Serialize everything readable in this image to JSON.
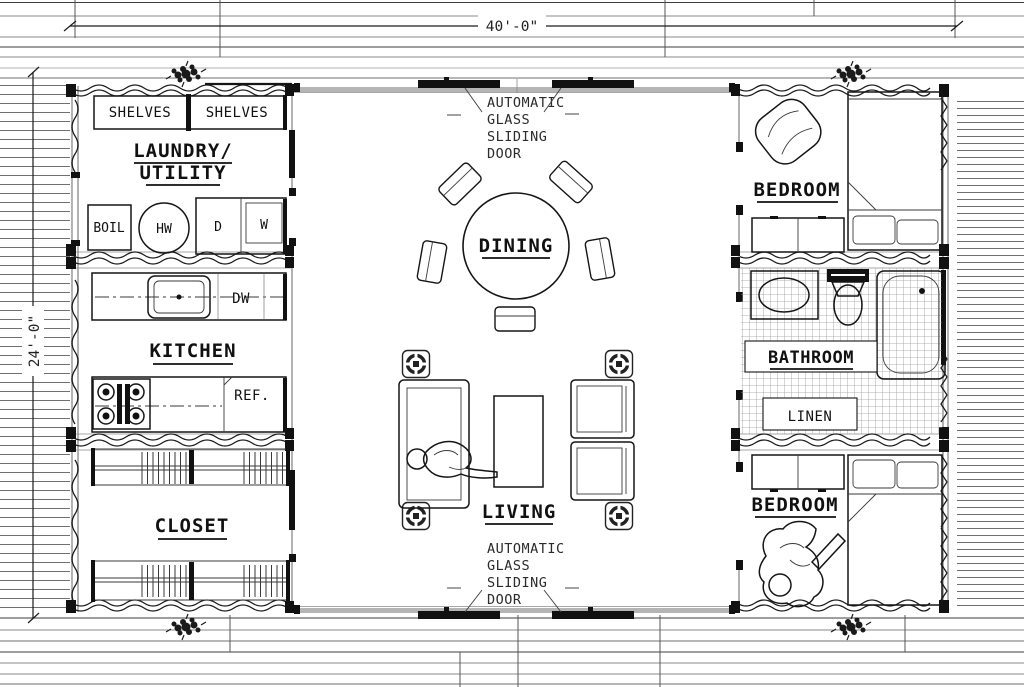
{
  "dimensions": {
    "width_label": "40'-0\"",
    "depth_label": "24'-0\""
  },
  "rooms": {
    "laundry_utility": {
      "name_line1": "LAUNDRY/",
      "name_line2": "UTILITY"
    },
    "kitchen": {
      "name": "KITCHEN"
    },
    "closet": {
      "name": "CLOSET"
    },
    "dining": {
      "name": "DINING"
    },
    "living": {
      "name": "LIVING"
    },
    "bedroom_top": {
      "name": "BEDROOM"
    },
    "bedroom_bottom": {
      "name": "BEDROOM"
    },
    "bathroom": {
      "name": "BATHROOM"
    },
    "linen": {
      "name": "LINEN"
    }
  },
  "fixtures": {
    "shelves_left": "SHELVES",
    "shelves_right": "SHELVES",
    "boiler": "BOIL",
    "hot_water": "HW",
    "dryer": "D",
    "washer": "W",
    "dishwasher": "DW",
    "refrigerator": "REF."
  },
  "doors": {
    "top": {
      "line1": "AUTOMATIC",
      "line2": "GLASS",
      "line3": "SLIDING",
      "line4": "DOOR"
    },
    "bottom": {
      "line1": "AUTOMATIC",
      "line2": "GLASS",
      "line3": "SLIDING",
      "line4": "DOOR"
    }
  },
  "colors": {
    "ink": "#111111",
    "wall_gray": "#b3b3b3",
    "deck_line": "#6f6f6f",
    "tile_line": "#9a9a9a"
  }
}
